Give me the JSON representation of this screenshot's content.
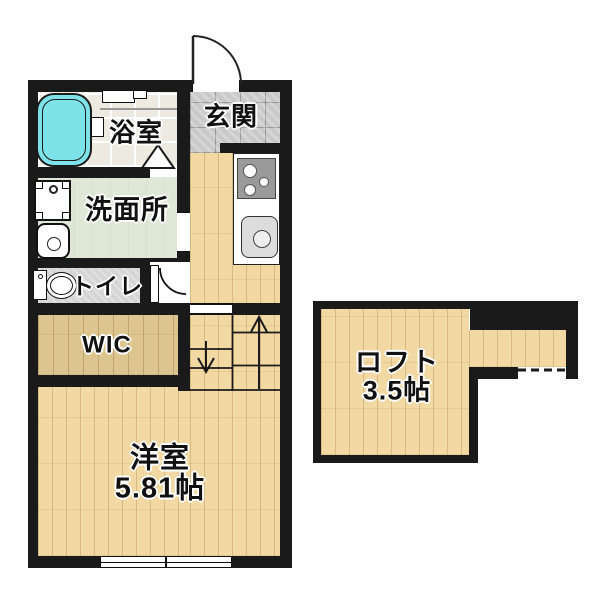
{
  "title": "apartment-floorplan",
  "rooms": {
    "genkan": {
      "label": "玄関"
    },
    "bathroom": {
      "label": "浴室"
    },
    "washroom": {
      "label": "洗面所"
    },
    "toilet": {
      "label": "トイレ"
    },
    "wic": {
      "label": "WIC"
    },
    "western_room": {
      "label": "洋室",
      "size": "5.81帖"
    },
    "loft": {
      "label": "ロフト",
      "size": "3.5帖"
    }
  },
  "fixtures": [
    "bathtub",
    "washing-machine",
    "washbasin",
    "toilet",
    "gas-stove",
    "kitchen-sink",
    "staircase-up-arrow",
    "staircase-down-arrow",
    "entrance-door",
    "toilet-door",
    "bathroom-folding-door",
    "window"
  ],
  "colors": {
    "background": "#ffffff",
    "wall": "#1a1a1a",
    "wood": "#f2d8a3",
    "wic_wood": "#dcc58f",
    "bath_tile": "#edebe1",
    "genkan_tile": "#c9c9c9",
    "washroom_floor": "#dfe8d7",
    "toilet_floor": "#d5d5d5",
    "bathtub": "#7de3e8",
    "stove": "#9a9a9a",
    "counter": "#ffffff"
  }
}
